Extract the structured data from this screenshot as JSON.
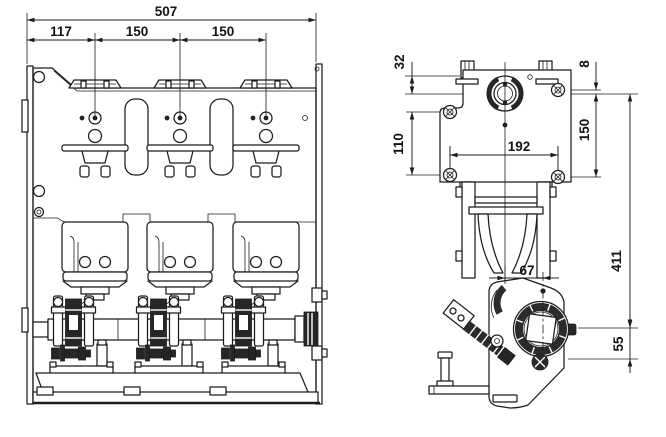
{
  "front_view": {
    "dims": {
      "overall_width": "507",
      "left_offset": "117",
      "pole_pitch_1": "150",
      "pole_pitch_2": "150"
    }
  },
  "side_view": {
    "dims": {
      "top_to_centerline": "32",
      "centerline_to_top_bolt": "8",
      "left_bolt_spacing": "110",
      "right_bolt_spacing": "150",
      "bolt_span_horizontal": "192",
      "centerline_to_shaft": "411",
      "shaft_horizontal_offset": "67",
      "shaft_to_lower_mount": "55"
    }
  }
}
